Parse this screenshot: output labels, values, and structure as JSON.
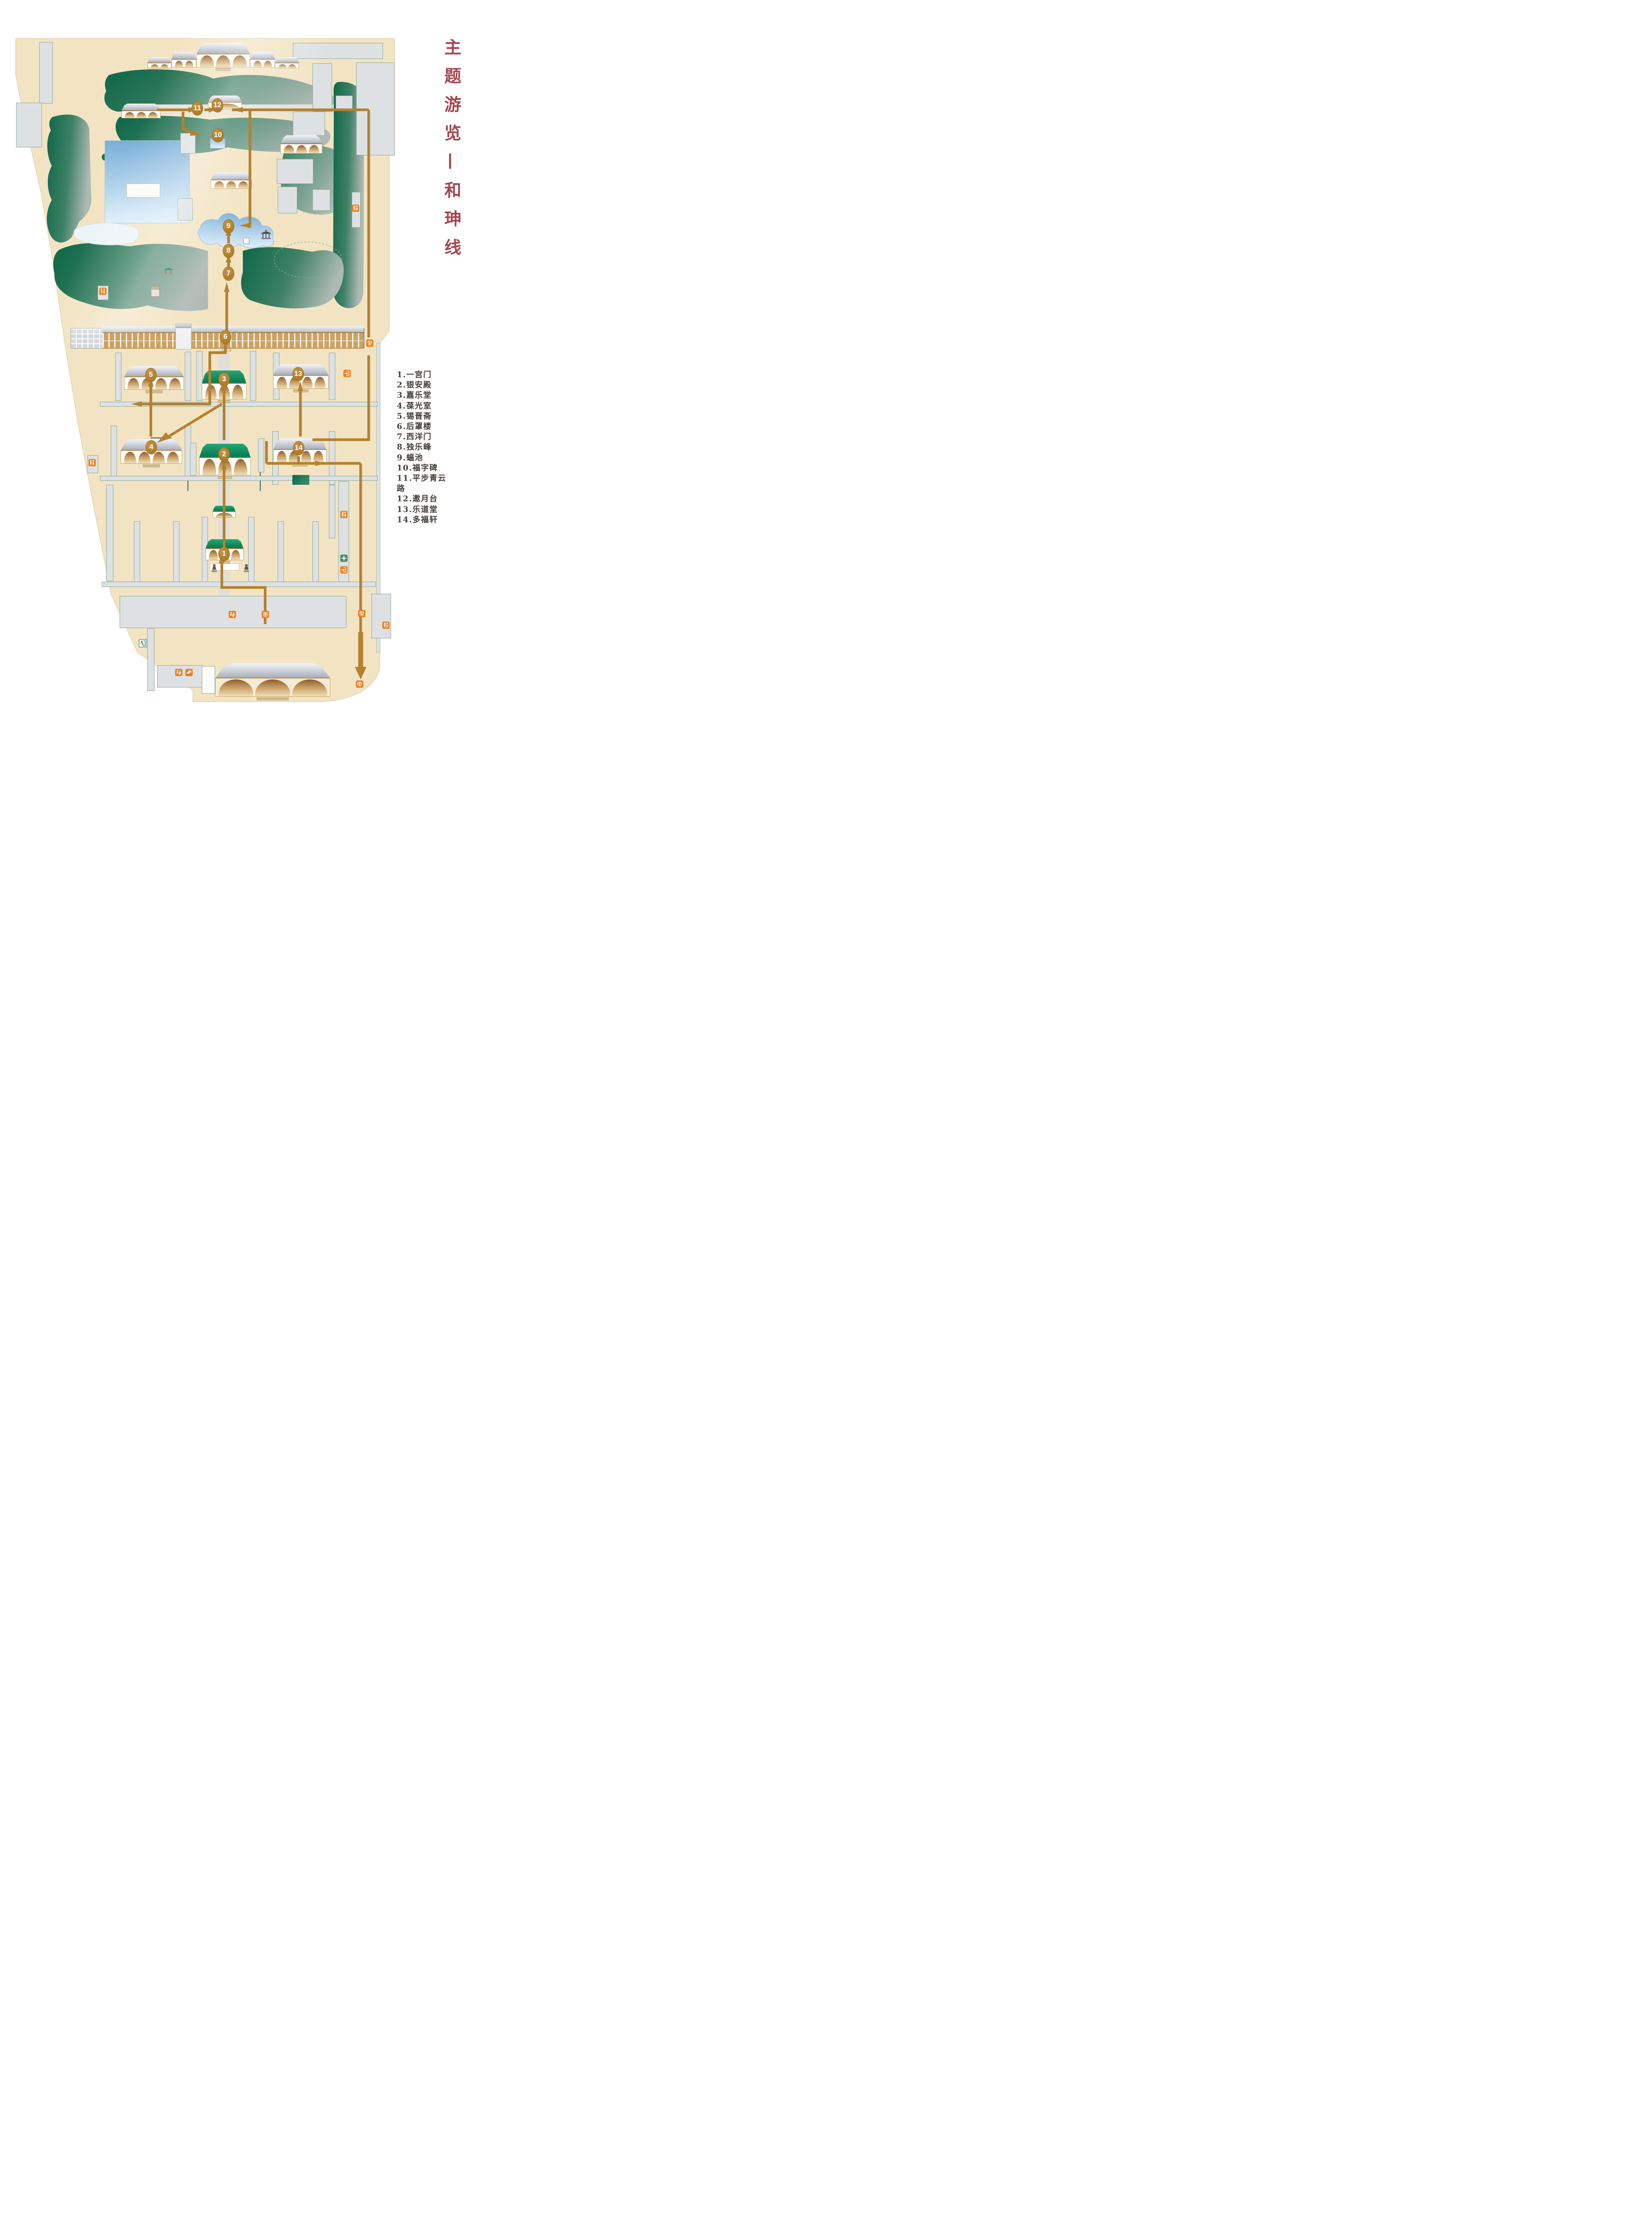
{
  "title": {
    "text": "主题游览—和珅线"
  },
  "legend": {
    "items": [
      "1.一宫门",
      "2.银安殿",
      "3.嘉乐堂",
      "4.葆光室",
      "5.锡晋斋",
      "6.后罩楼",
      "7.西洋门",
      "8.独乐峰",
      "9.蝠池",
      "10.福字碑",
      "11.平步青云路",
      "12.邀月台",
      "13.乐道堂",
      "14.多福轩"
    ]
  },
  "markers": [
    {
      "n": "1",
      "label": "一宫门"
    },
    {
      "n": "2",
      "label": "银安殿"
    },
    {
      "n": "3",
      "label": "嘉乐堂"
    },
    {
      "n": "4",
      "label": "葆光室"
    },
    {
      "n": "5",
      "label": "锡晋斋"
    },
    {
      "n": "6",
      "label": "后罩楼"
    },
    {
      "n": "7",
      "label": "西洋门"
    },
    {
      "n": "8",
      "label": "独乐峰"
    },
    {
      "n": "9",
      "label": "蝠池"
    },
    {
      "n": "10",
      "label": "福字碑"
    },
    {
      "n": "11",
      "label": "平步青云路"
    },
    {
      "n": "12",
      "label": "邀月台"
    },
    {
      "n": "13",
      "label": "乐道堂"
    },
    {
      "n": "14",
      "label": "多福轩"
    }
  ],
  "tour": {
    "name": "和珅线",
    "order": [
      1,
      2,
      3,
      4,
      5,
      6,
      7,
      8,
      9,
      10,
      11,
      12,
      13,
      14
    ]
  },
  "icons": {
    "toilet-icon": "restrooms",
    "exit-gate-icon": "exit (arrow out of gate)",
    "entrance-gate-icon": "entrance (arrow into gate)",
    "entrance-up-icon": "entrance (arrow up into gate)",
    "first-aid-icon": "first aid station",
    "emergency-exit-icon": "emergency exit (running man)",
    "service-desk-icon": "visitor service / luggage desk",
    "ticket-icon": "ticket office"
  },
  "colors": {
    "title_red": "#A5454F",
    "legend_text": "#44403B",
    "route_brown": "#B5812F",
    "icon_orange": "#EC7D1C",
    "first_aid_green": "#4D8663",
    "land_beige": "#F2E4C2",
    "water_blue": "#79AFD9",
    "rock_green": "#0E6647",
    "roof_green": "#0E8E62",
    "building_gray": "#DDE1E4"
  }
}
